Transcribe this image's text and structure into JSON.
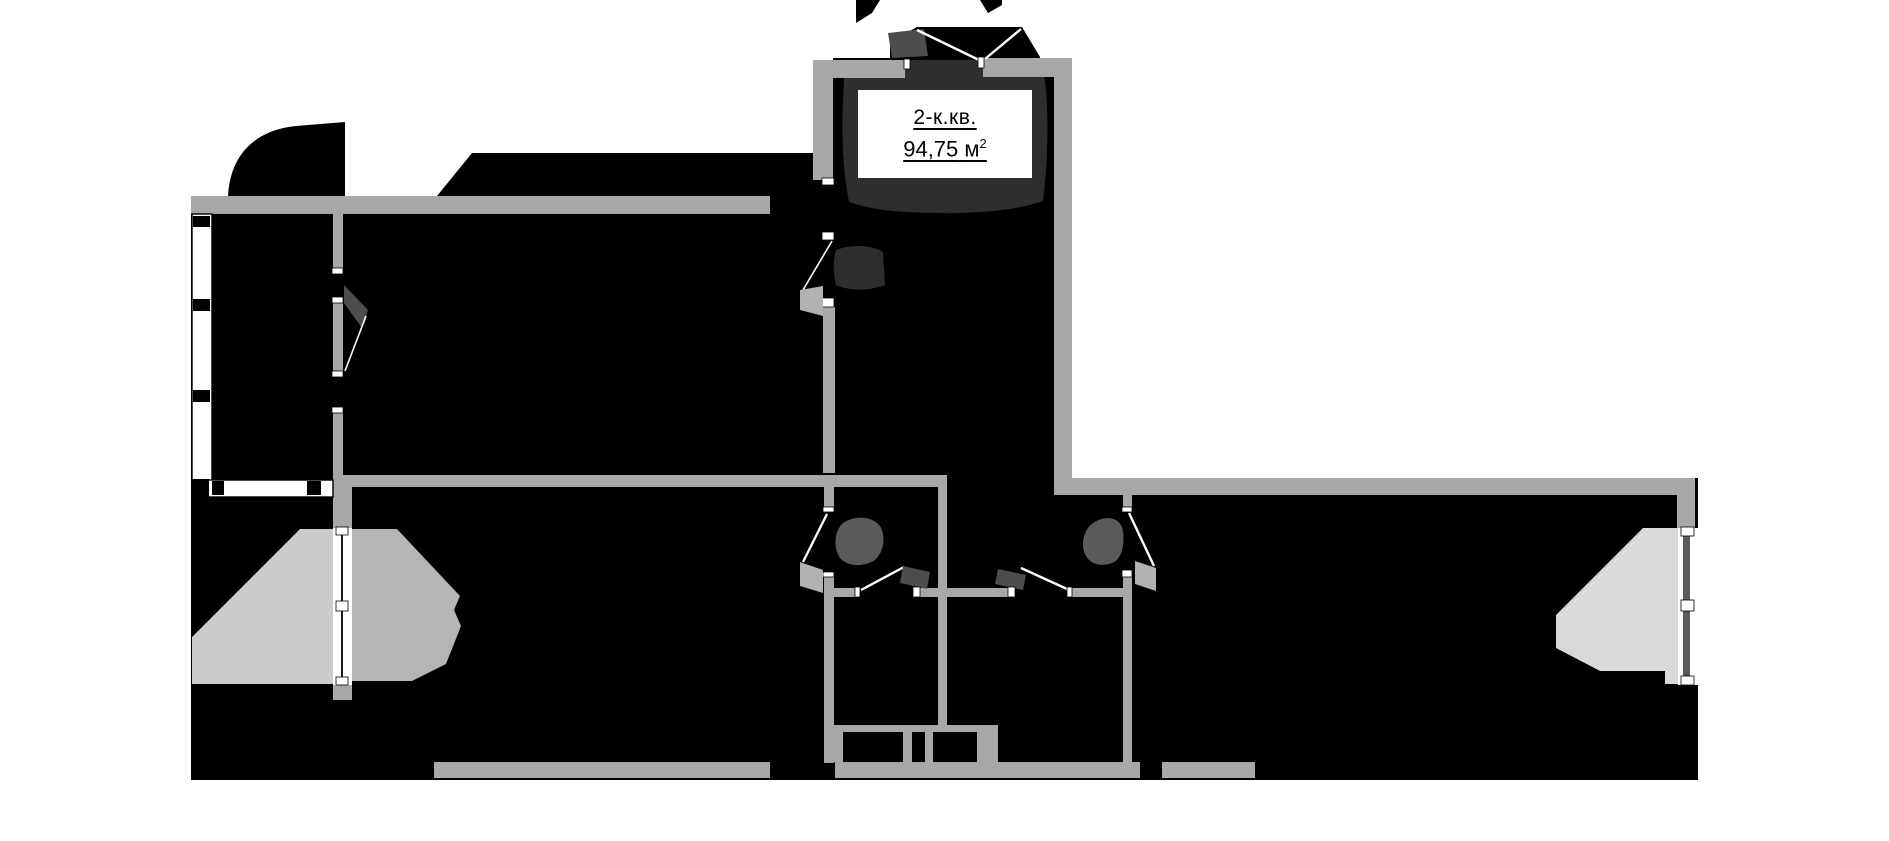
{
  "plan": {
    "unit_label": {
      "type_text": "2-к.кв.",
      "area_value": "94,75",
      "area_unit": "м",
      "area_sup": "2",
      "area_full": "94,75 м²"
    },
    "features": [
      "entrance-double-door",
      "vestibule",
      "hallway",
      "wc-toilet-left",
      "wc-toilet-right",
      "bathroom-doors",
      "left-balcony-with-railing",
      "left-bay-window",
      "right-bay-window",
      "bottom-window-bay"
    ],
    "palette": {
      "bg": "#ffffff",
      "plate": "#000000",
      "wall": "#a8a8a8",
      "room_dark": "#2e2e2e",
      "fixture": "#4d4d4d",
      "toilet": "#5a5a5a",
      "bay_light": "#cbcbcb",
      "bay_mid": "#b5b5b5",
      "bay_right": "#d9d9d9",
      "leaf_light": "#b2b2b2",
      "glass_line": "#5a5a5a",
      "text": "#000000"
    }
  }
}
